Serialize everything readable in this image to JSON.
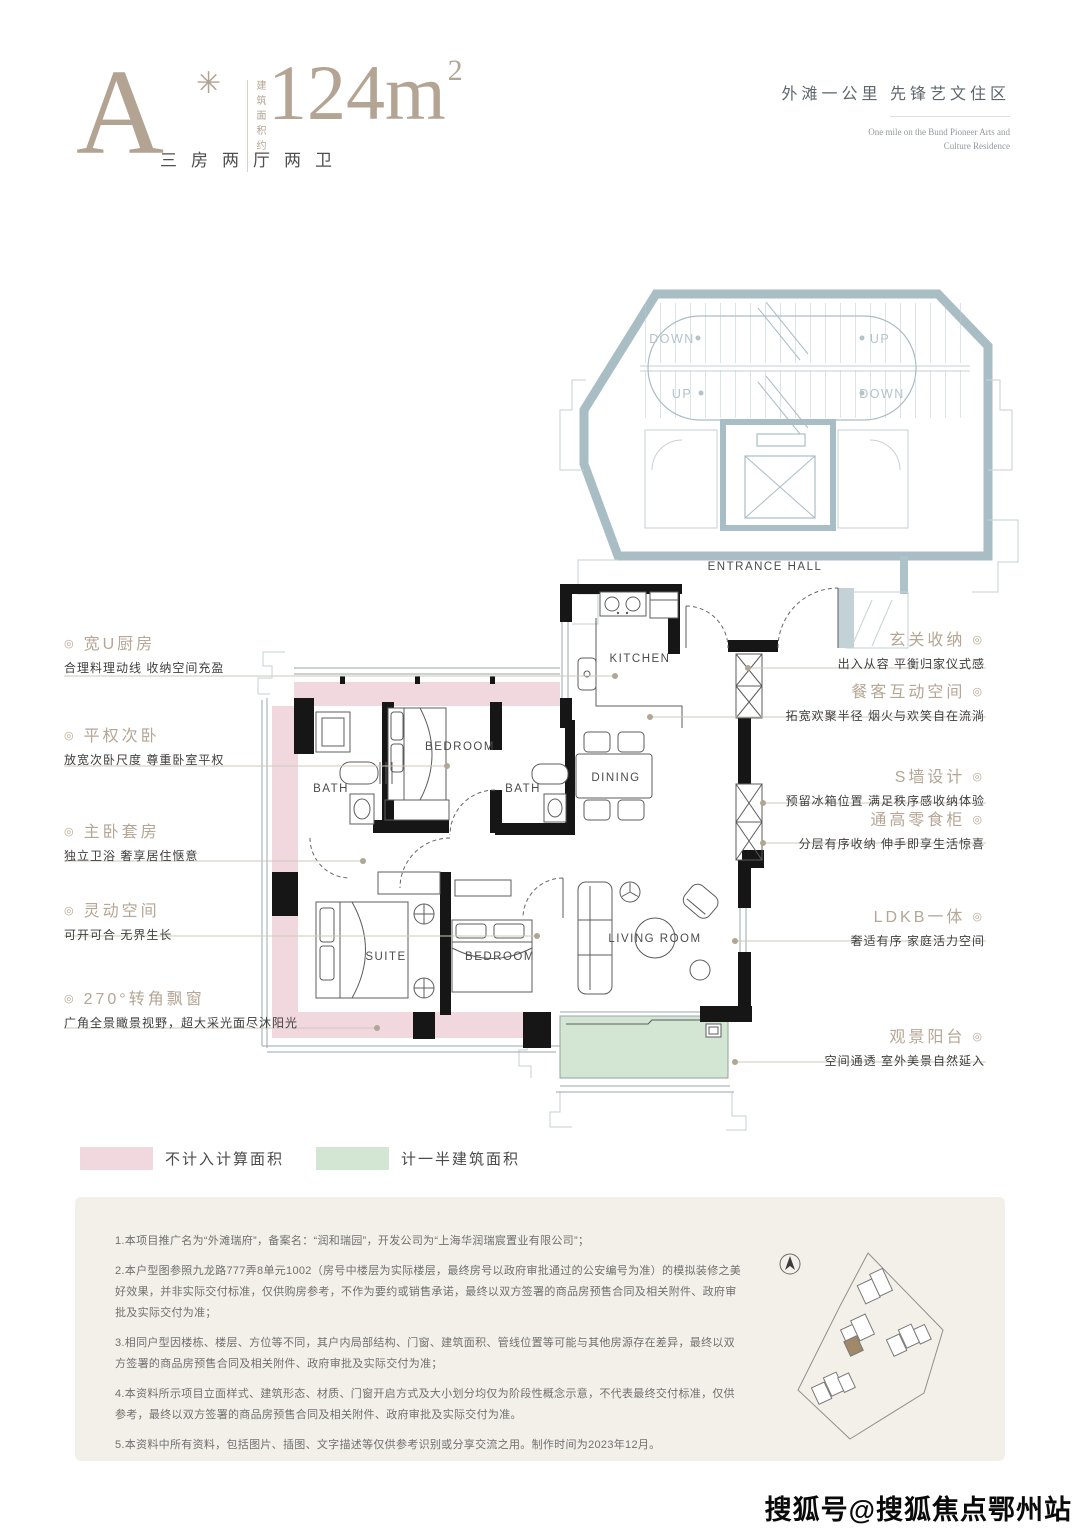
{
  "header": {
    "plan_type": "A",
    "plan_type_mark": "✳",
    "area_prefix_vertical": "建筑面积约",
    "area_value": "124m",
    "area_sup": "2",
    "rooms_summary": "三房两厅两卫",
    "slogan_cn": "外滩一公里 先锋艺文住区",
    "slogan_en_1": "One mile on the Bund Pioneer Arts and",
    "slogan_en_2": "Culture Residence"
  },
  "plan": {
    "rooms": {
      "kitchen": "KITCHEN",
      "bedroom_top": "BEDROOM",
      "bath_left": "BATH",
      "bath_mid": "BATH",
      "dining": "DINING",
      "suite": "SUITE",
      "bedroom_bottom": "BEDROOM",
      "living_room": "LIVING ROOM",
      "entrance_hall": "ENTRANCE HALL"
    },
    "stair_labels": {
      "down_upper": "DOWN",
      "up_upper": "UP",
      "up_lower": "UP",
      "down_lower": "DOWN"
    },
    "colors": {
      "excluded_area": "#f1d8de",
      "half_area": "#d2e6d3",
      "stair_tone": "#aec3c8",
      "wall": "#161616",
      "leader_line": "#cfc8bd",
      "accent_tan": "#b5a695"
    }
  },
  "annotations": {
    "bullet": "◎",
    "left": [
      {
        "title": "宽U厨房",
        "desc": "合理料理动线 收纳空间充盈"
      },
      {
        "title": "平权次卧",
        "desc": "放宽次卧尺度 尊重卧室平权"
      },
      {
        "title": "主卧套房",
        "desc": "独立卫浴 奢享居住惬意"
      },
      {
        "title": "灵动空间",
        "desc": "可开可合 无界生长"
      },
      {
        "title": "270°转角飘窗",
        "desc": "广角全景瞰景视野，超大采光面尽沐阳光"
      }
    ],
    "right": [
      {
        "title": "玄关收纳",
        "desc": "出入从容 平衡归家仪式感"
      },
      {
        "title": "餐客互动空间",
        "desc": "拓宽欢聚半径 烟火与欢笑自在流淌"
      },
      {
        "title": "S墙设计",
        "desc": "预留冰箱位置 满足秩序感收纳体验"
      },
      {
        "title": "通高零食柜",
        "desc": "分层有序收纳 伸手即享生活惊喜"
      },
      {
        "title": "LDKB一体",
        "desc": "奢适有序 家庭活力空间"
      },
      {
        "title": "观景阳台",
        "desc": "空间通透 室外美景自然延入"
      }
    ]
  },
  "legend": {
    "items": [
      {
        "label": "不计入计算面积",
        "color": "#f1d8de"
      },
      {
        "label": "计一半建筑面积",
        "color": "#d2e6d3"
      }
    ]
  },
  "disclaimer": {
    "items": [
      "1.本项目推广名为“外滩瑞府”，备案名：“润和瑞园”，开发公司为“上海华润瑞宸置业有限公司”；",
      "2.本户型图参照九龙路777弄8单元1002（房号中楼层为实际楼层，最终房号以政府审批通过的公安编号为准）的模拟装修之美好效果，并非实际交付标准，仅供购房参考，不作为要约或销售承诺，最终以双方签署的商品房预售合同及相关附件、政府审批及实际交付为准；",
      "3.相同户型因楼栋、楼层、方位等不同，其户内局部结构、门窗、建筑面积、管线位置等可能与其他房源存在差异，最终以双方签署的商品房预售合同及相关附件、政府审批及实际交付为准；",
      "4.本资料所示项目立面样式、建筑形态、材质、门窗开启方式及大小划分均仅为阶段性概念示意，不代表最终交付标准，仅供参考，最终以双方签署的商品房预售合同及相关附件、政府审批及实际交付为准。",
      "5.本资料中所有资料，包括图片、插图、文字描述等仅供参考识别或分享交流之用。制作时间为2023年12月。"
    ]
  },
  "watermark": "搜狐号@搜狐焦点鄂州站"
}
